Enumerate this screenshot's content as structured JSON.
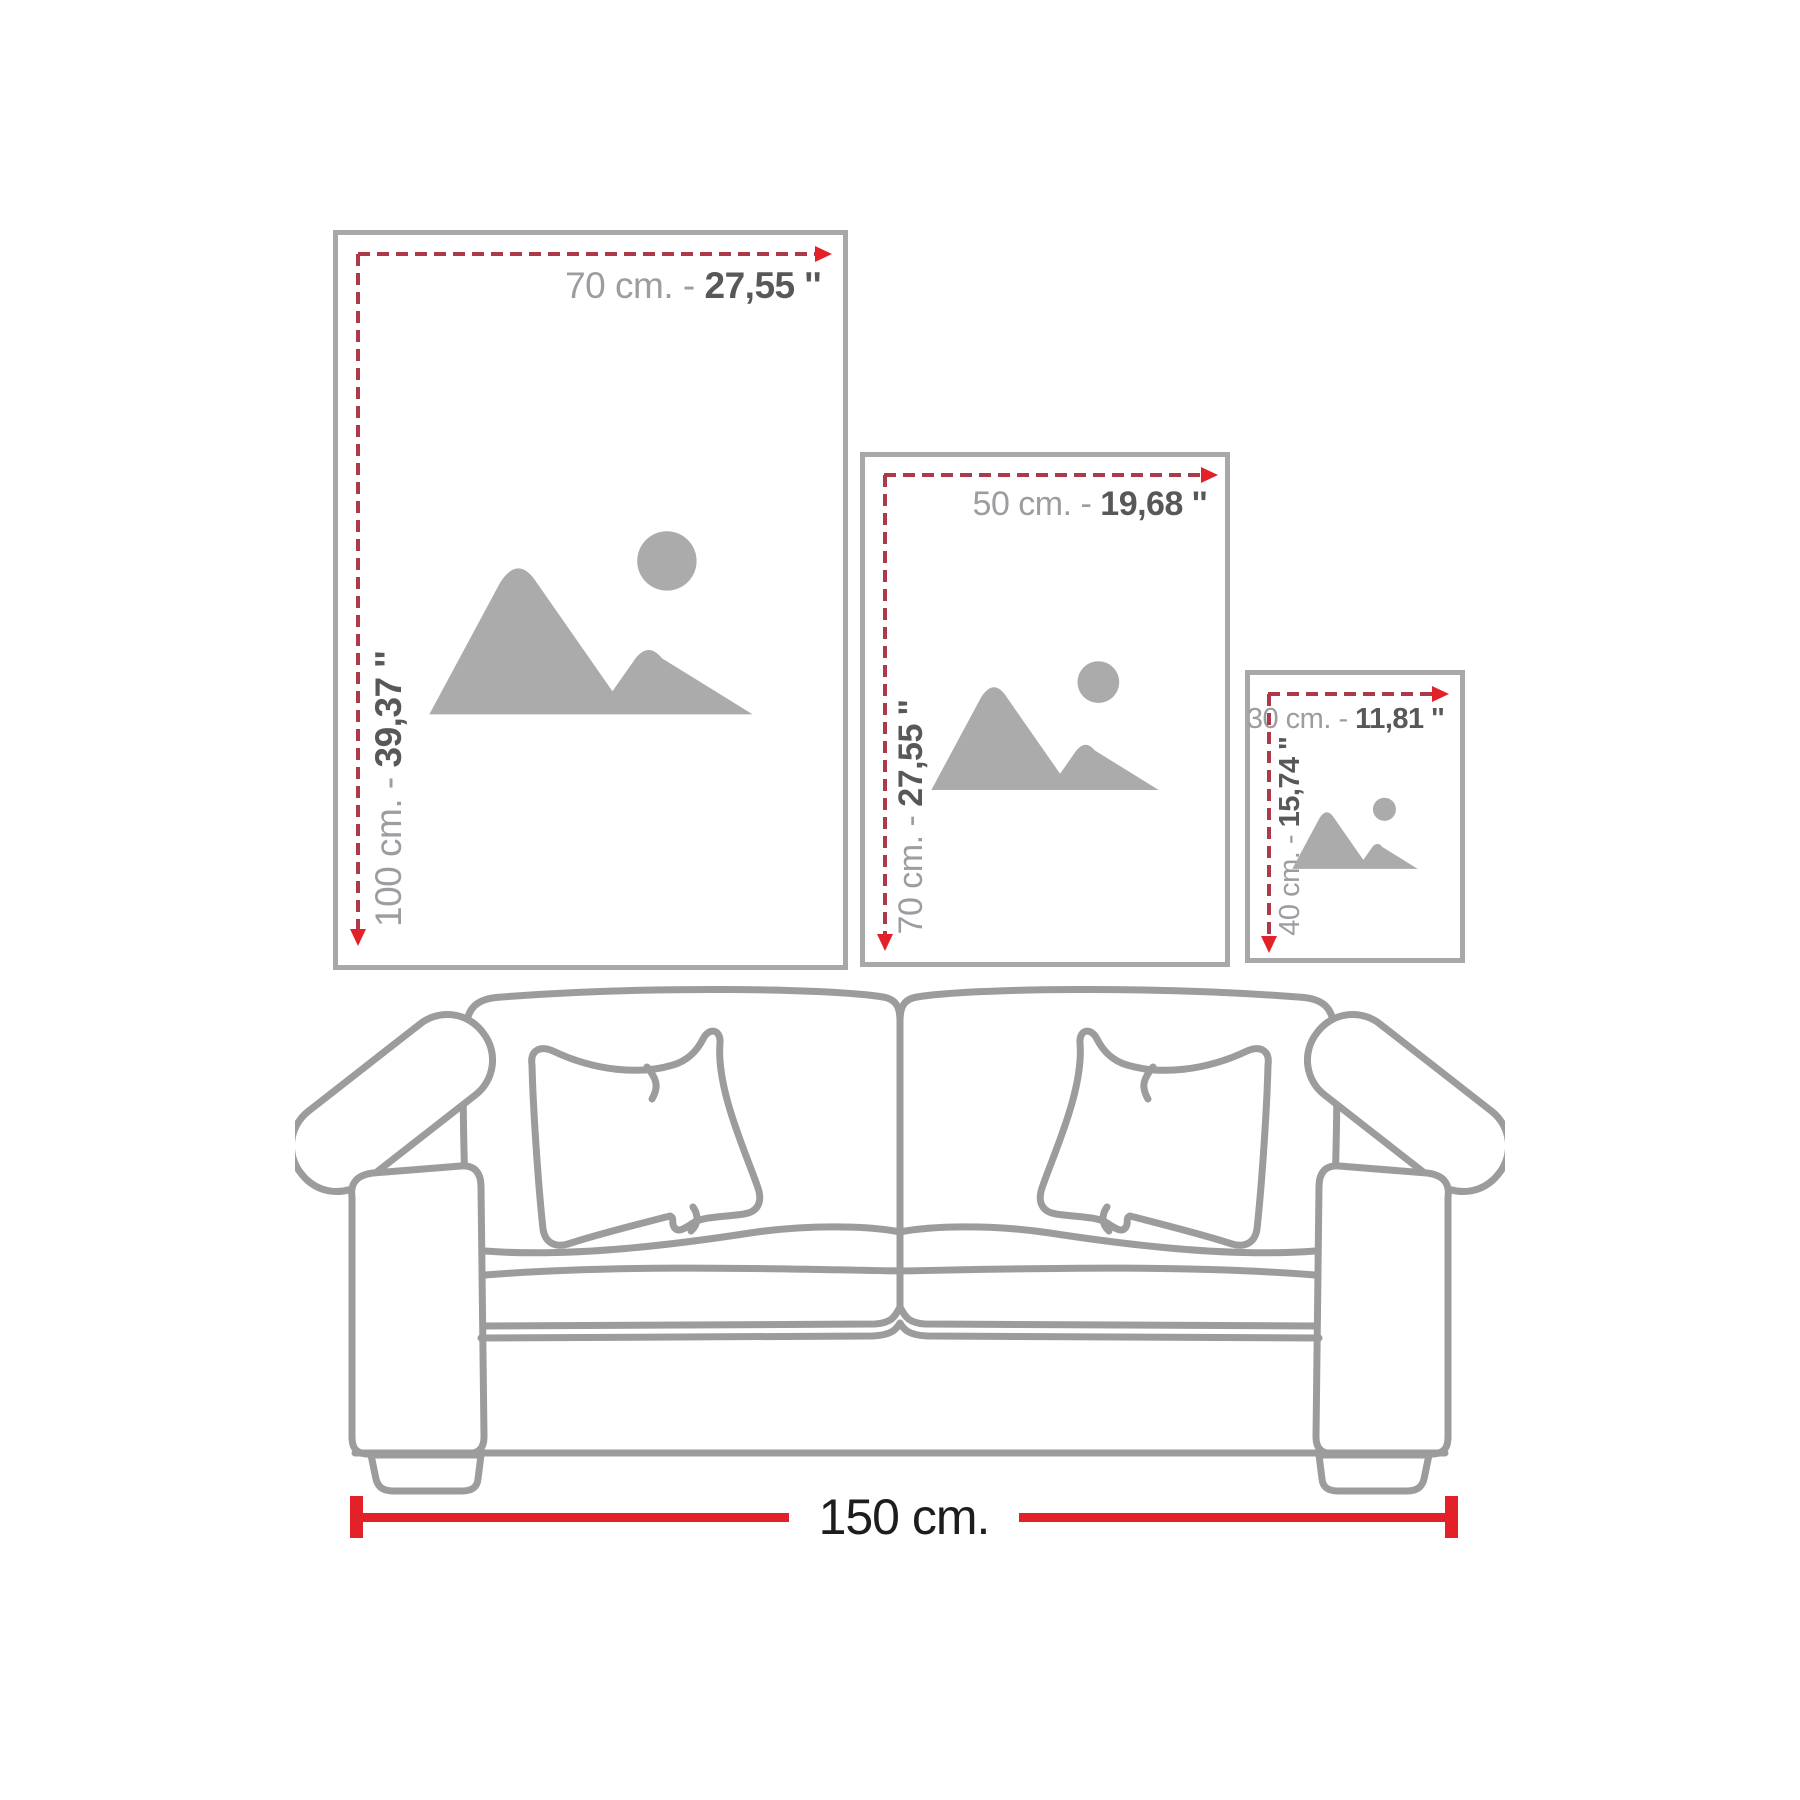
{
  "page": {
    "background": "#ffffff"
  },
  "frames": [
    {
      "name": "large-frame",
      "width_label": "70 cm. -",
      "width_value": "27,55 ''",
      "height_label": "100 cm. -",
      "height_value": "39,37 ''"
    },
    {
      "name": "medium-frame",
      "width_label": "50 cm. -",
      "width_value": "19,68 ''",
      "height_label": "70 cm. -",
      "height_value": "27,55 ''"
    },
    {
      "name": "small-frame",
      "width_label": "30 cm. -",
      "width_value": "11,81 ''",
      "height_label": "40 cm. -",
      "height_value": "15,74 ''"
    }
  ],
  "sofa": {
    "width_label": "150 cm."
  },
  "colors": {
    "frame_border": "#a8a8a8",
    "placeholder_gray": "#ababab",
    "dash_red": "#ad3a4a",
    "arrow_red": "#e32128",
    "measure_red": "#e32128",
    "label_gray": "#9b9da0",
    "label_dark": "#57585a",
    "sofa_outline": "#9c9c9c",
    "sofa_label_dark": "#1d1d1f"
  }
}
